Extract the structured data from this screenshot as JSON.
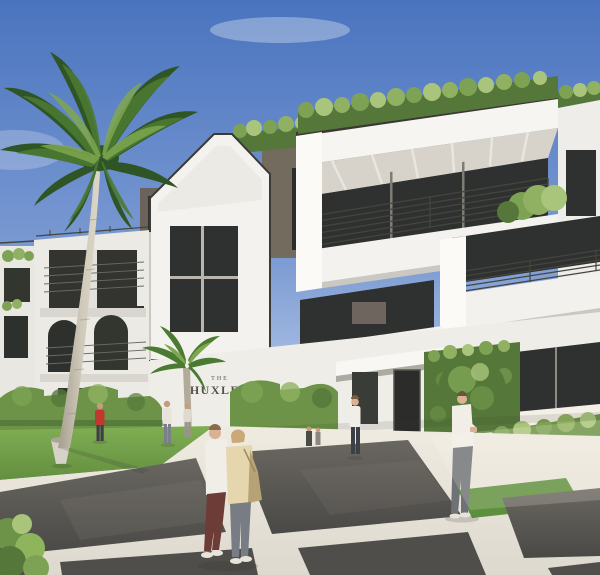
{
  "meta": {
    "type": "architectural-rendering",
    "description": "Sunny exterior rendering of The Huxley, a three-story white modern condominium with rooftop garden hedges, deep white terraces, dark metal railings, bronze fascia accents, sculpted hedges, a tall royal palm and pedestrians on a paver plaza street."
  },
  "sign": {
    "line1": "THE",
    "line2": "HUXLEY"
  },
  "palette": {
    "sky-top": "#4a74bf",
    "sky-mid": "#7c9bd3",
    "sky-horizon": "#dde7f3",
    "cloud": "#eef3f9",
    "wall-white": "#f4f2ee",
    "wall-bright": "#fbfaf7",
    "wall-shade": "#e3e1db",
    "wall-dark-shade": "#cbc8c1",
    "fascia-bronze": "#746b5f",
    "coping-dark": "#3a3833",
    "glass-dark": "#2e312f",
    "glass-frame": "#8e8c85",
    "railing": "#45453f",
    "soffit": "#d7d3cb",
    "hedge-green": "#7da254",
    "hedge-dark": "#55783a",
    "hedge-light": "#a9c57b",
    "lawn": "#6f9d4a",
    "grass-inset": "#5d8f3e",
    "palm-dark": "#2f5527",
    "palm-mid": "#4b7a33",
    "palm-light": "#7fa74f",
    "trunk": "#c9c3b4",
    "trunk-shade": "#a59e8e",
    "concrete": "#e9e5dc",
    "concrete-bright": "#f4f0e7",
    "asphalt": "#5d5b57",
    "asphalt-dark": "#4a4946",
    "joint-white": "#ece9e1",
    "sign-text": "#57534b",
    "skin": "#d9b296",
    "shirt-white": "#f1eee8",
    "pants-maroon": "#6d3c36",
    "jacket-cream": "#e6d6ae",
    "jeans-gray": "#787c84",
    "bag-tan": "#b5a375",
    "red-top": "#c0392f",
    "pants-dark": "#3c3f46"
  },
  "people": [
    {
      "id": "couple-man",
      "desc": "Man walking in crosswalk, white long-sleeve top, maroon pants, white sneakers"
    },
    {
      "id": "couple-woman",
      "desc": "Woman walking beside him, cream jacket, gray jeans, tan shoulder bag"
    },
    {
      "id": "man-right",
      "desc": "Man standing on right sidewalk, white shirt, gray trousers"
    },
    {
      "id": "entrance-person",
      "desc": "Person near entrance steps, white top, dark pants"
    },
    {
      "id": "person-red",
      "desc": "Person in red top on left walkway"
    },
    {
      "id": "person-light",
      "desc": "Distant light-dressed figures on left walkway"
    }
  ],
  "landmarks": [
    "royal-palm-tree",
    "rooftop-garden-hedges",
    "white-terraces",
    "gable-facade",
    "building-sign",
    "entry-door",
    "ivy-green-wall",
    "topiary-ball",
    "sculpted-hedges",
    "lawn",
    "paver-street-crosswalk",
    "planter-pot"
  ]
}
